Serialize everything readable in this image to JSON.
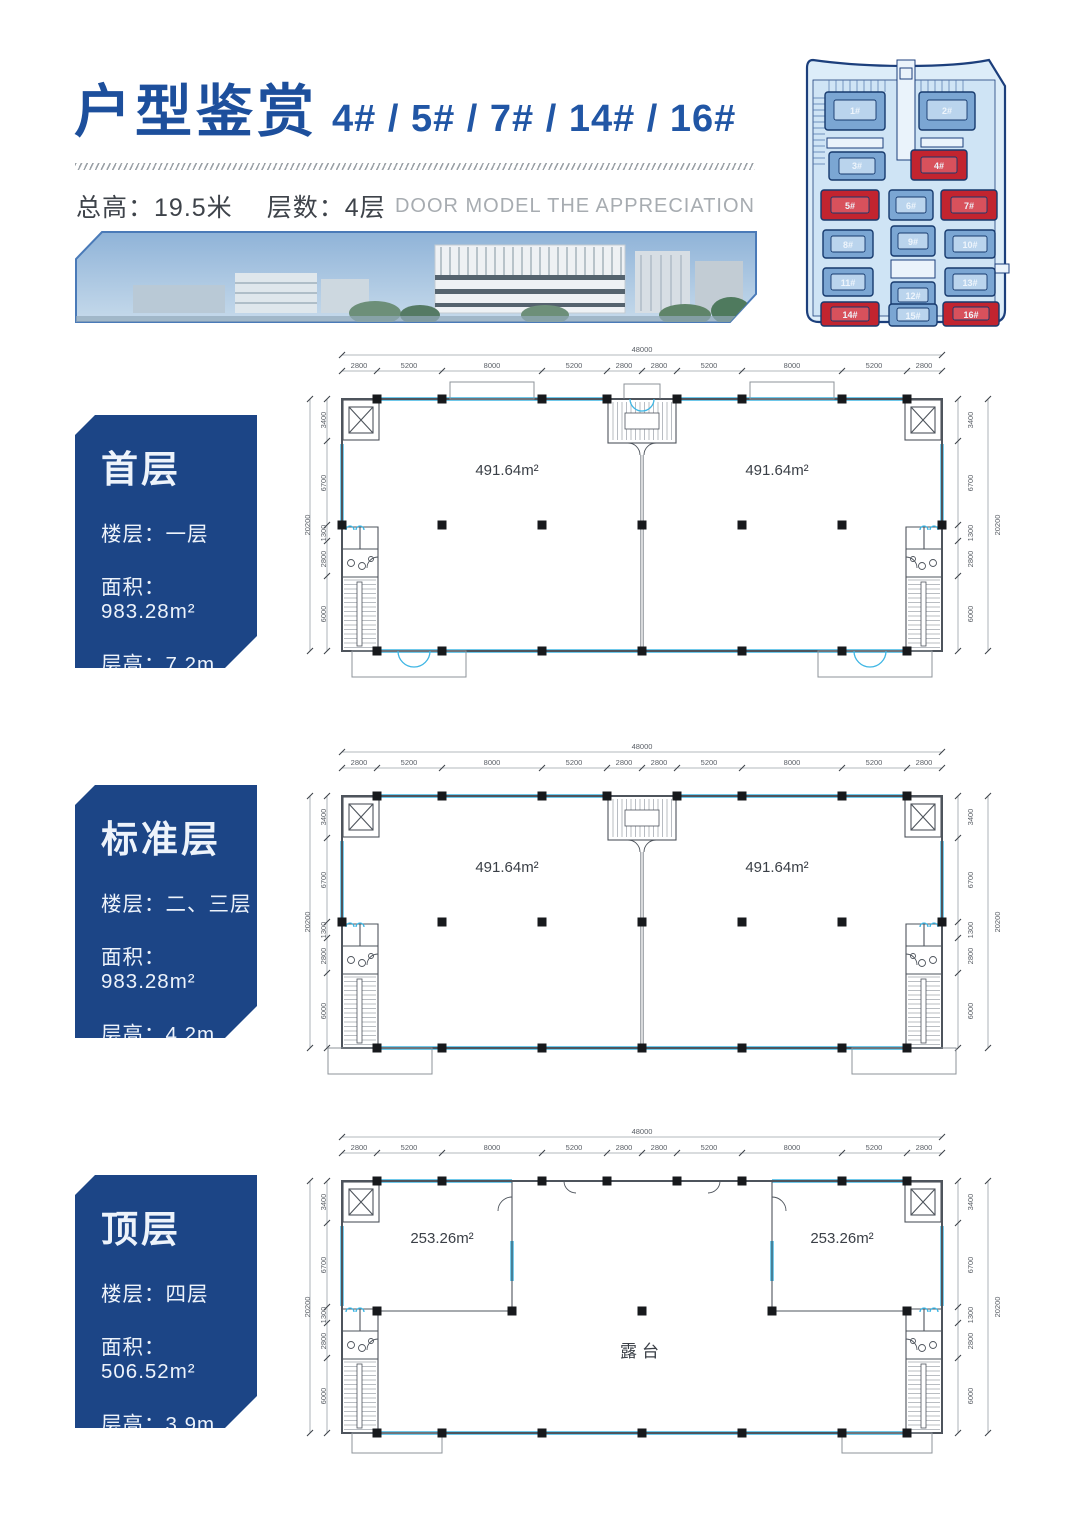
{
  "header": {
    "title": "户型鉴赏",
    "buildings": "4# / 5# / 7# / 14# / 16#",
    "total_height_label": "总高：",
    "total_height": "19.5米",
    "floors_label": "层数：",
    "floors": "4层",
    "english_subtitle": "DOOR MODEL THE APPRECIATION"
  },
  "siteplan": {
    "buildings": [
      {
        "id": "1#",
        "highlight": false
      },
      {
        "id": "2#",
        "highlight": false
      },
      {
        "id": "3#",
        "highlight": false
      },
      {
        "id": "4#",
        "highlight": true
      },
      {
        "id": "5#",
        "highlight": true
      },
      {
        "id": "6#",
        "highlight": false
      },
      {
        "id": "7#",
        "highlight": true
      },
      {
        "id": "8#",
        "highlight": false
      },
      {
        "id": "9#",
        "highlight": false
      },
      {
        "id": "10#",
        "highlight": false
      },
      {
        "id": "11#",
        "highlight": false
      },
      {
        "id": "12#",
        "highlight": false
      },
      {
        "id": "13#",
        "highlight": false
      },
      {
        "id": "14#",
        "highlight": true
      },
      {
        "id": "15#",
        "highlight": false
      },
      {
        "id": "16#",
        "highlight": true
      }
    ]
  },
  "dims": {
    "top_total": "48000",
    "top": [
      "2800",
      "5200",
      "8000",
      "5200",
      "2800",
      "2800",
      "5200",
      "8000",
      "5200",
      "2800"
    ],
    "side_total": "20200",
    "side": [
      "3400",
      "6700",
      "1300",
      "2800",
      "6000"
    ]
  },
  "plans": [
    {
      "name": "首层",
      "floor": "楼层：一层",
      "area": "面积：983.28m²",
      "height": "层高：7.2m",
      "unit_area_left": "491.64m²",
      "unit_area_right": "491.64m²"
    },
    {
      "name": "标准层",
      "floor": "楼层：二、三层",
      "area": "面积：983.28m²",
      "height": "层高：4.2m",
      "unit_area_left": "491.64m²",
      "unit_area_right": "491.64m²"
    },
    {
      "name": "顶层",
      "floor": "楼层：四层",
      "area": "面积：506.52m²",
      "height": "层高：3.9m",
      "unit_area_left": "253.26m²",
      "unit_area_right": "253.26m²",
      "terrace": "露台"
    }
  ],
  "colors": {
    "primary_blue": "#1d4f9c",
    "card_navy": "#1c4586",
    "window_cyan": "#3fb6e4",
    "highlight_red": "#c2242f"
  }
}
